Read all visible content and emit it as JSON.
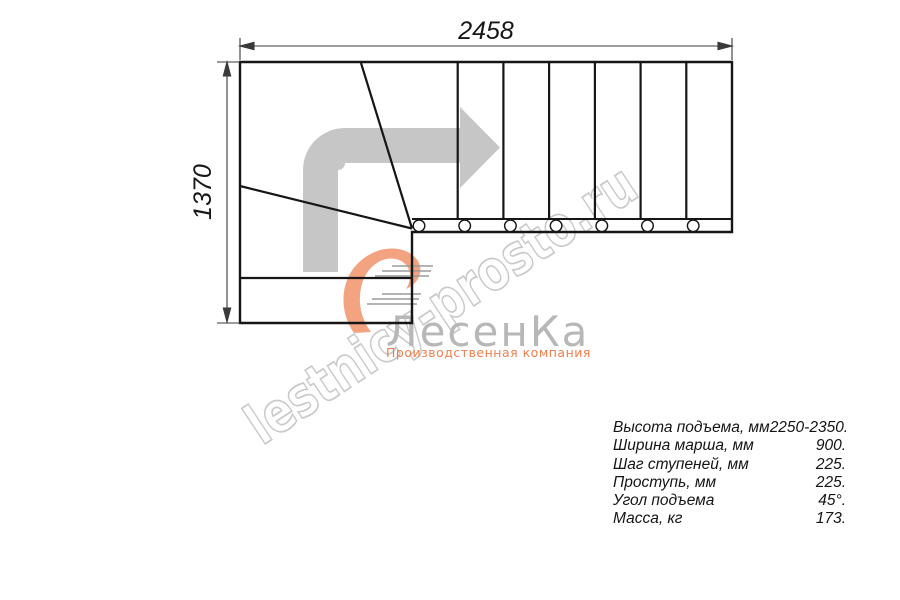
{
  "page": {
    "background_color": "#ffffff"
  },
  "watermark": {
    "text": "lestnicy-prosto.ru",
    "color": "#c9c9c9"
  },
  "logo": {
    "name": "ЛесенКа",
    "tagline": "Производственная компания",
    "name_color": "#b7b7b7",
    "tagline_color": "#ec7f4e",
    "swoosh_color": "#f29972",
    "speed_lines_color": "#9b9b9b"
  },
  "drawing": {
    "top_dimension_mm": "2458",
    "left_dimension_mm": "1370",
    "line_color": "#161616",
    "dimension_line_color": "#3a3a3a",
    "direction_arrow_color": "#c6c6c6"
  },
  "specs": {
    "rows": [
      {
        "label": "Высота подъема, мм",
        "value": "2250-2350."
      },
      {
        "label": "Ширина марша, мм",
        "value": "900."
      },
      {
        "label": "Шаг ступеней, мм",
        "value": "225."
      },
      {
        "label": "Проступь, мм",
        "value": "225."
      },
      {
        "label": "Угол подъема",
        "value": "45°."
      },
      {
        "label": "Масса, кг",
        "value": "173."
      }
    ]
  }
}
